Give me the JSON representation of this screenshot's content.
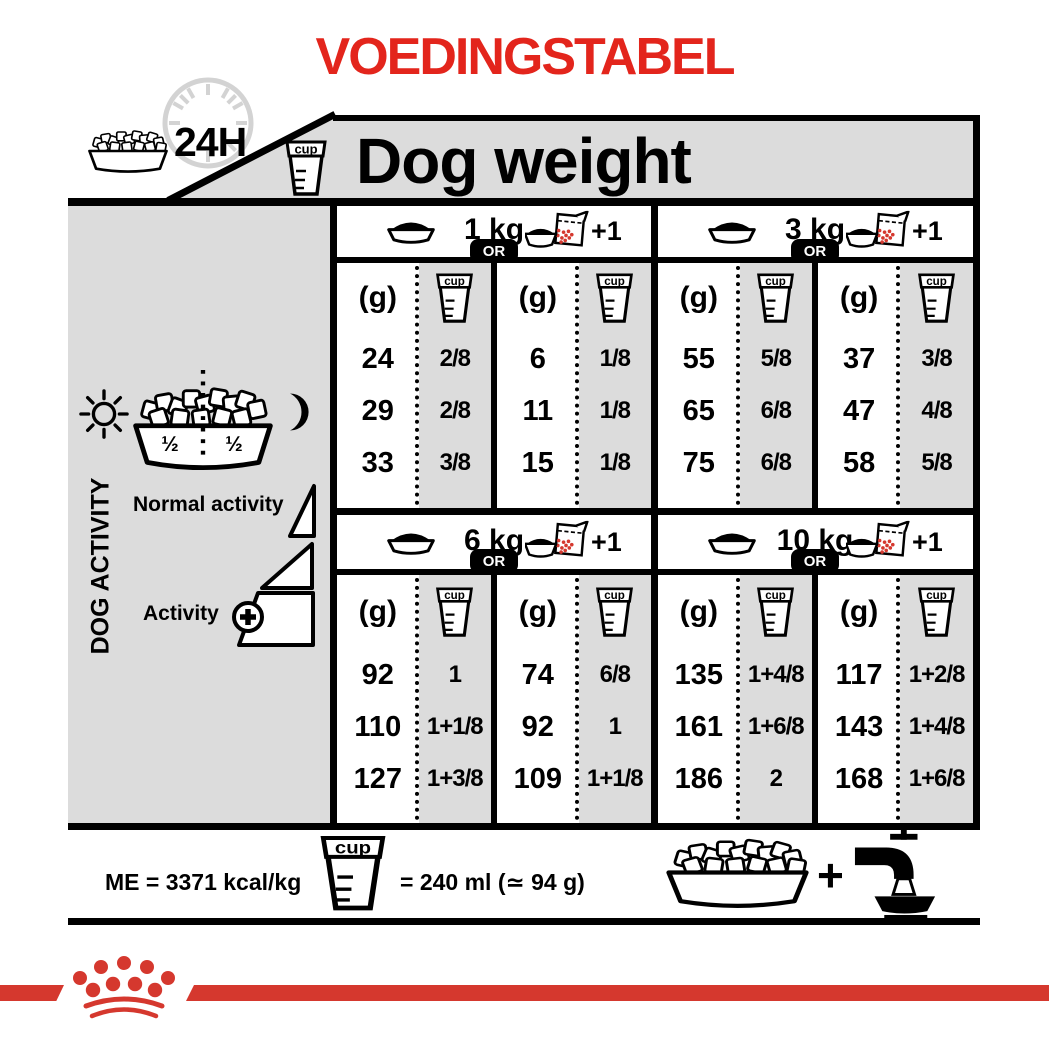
{
  "title": "VOEDINGSTABEL",
  "header": {
    "time_badge": "24H",
    "dog_weight": "Dog weight"
  },
  "sidebar": {
    "dog_activity": "DOG ACTIVITY",
    "half_left": "½",
    "half_right": "½",
    "normal_activity": "Normal activity",
    "activity": "Activity"
  },
  "table": {
    "or": "OR",
    "plus_one": "+1",
    "grams_header": "(g)",
    "cup_label": "cup",
    "sections": [
      {
        "weight": "1 kg",
        "dry": {
          "rows": [
            {
              "g": "24",
              "cup": "2/8"
            },
            {
              "g": "29",
              "cup": "2/8"
            },
            {
              "g": "33",
              "cup": "3/8"
            }
          ]
        },
        "mix": {
          "rows": [
            {
              "g": "6",
              "cup": "1/8"
            },
            {
              "g": "11",
              "cup": "1/8"
            },
            {
              "g": "15",
              "cup": "1/8"
            }
          ]
        }
      },
      {
        "weight": "3 kg",
        "dry": {
          "rows": [
            {
              "g": "55",
              "cup": "5/8"
            },
            {
              "g": "65",
              "cup": "6/8"
            },
            {
              "g": "75",
              "cup": "6/8"
            }
          ]
        },
        "mix": {
          "rows": [
            {
              "g": "37",
              "cup": "3/8"
            },
            {
              "g": "47",
              "cup": "4/8"
            },
            {
              "g": "58",
              "cup": "5/8"
            }
          ]
        }
      },
      {
        "weight": "6 kg",
        "dry": {
          "rows": [
            {
              "g": "92",
              "cup": "1"
            },
            {
              "g": "110",
              "cup": "1+1/8"
            },
            {
              "g": "127",
              "cup": "1+3/8"
            }
          ]
        },
        "mix": {
          "rows": [
            {
              "g": "74",
              "cup": "6/8"
            },
            {
              "g": "92",
              "cup": "1"
            },
            {
              "g": "109",
              "cup": "1+1/8"
            }
          ]
        }
      },
      {
        "weight": "10 kg",
        "dry": {
          "rows": [
            {
              "g": "135",
              "cup": "1+4/8"
            },
            {
              "g": "161",
              "cup": "1+6/8"
            },
            {
              "g": "186",
              "cup": "2"
            }
          ]
        },
        "mix": {
          "rows": [
            {
              "g": "117",
              "cup": "1+2/8"
            },
            {
              "g": "143",
              "cup": "1+4/8"
            },
            {
              "g": "168",
              "cup": "1+6/8"
            }
          ]
        }
      }
    ]
  },
  "footer": {
    "me": "ME = 3371 kcal/kg",
    "cup_equiv": "= 240 ml (≃ 94 g)",
    "plus": "+"
  },
  "colors": {
    "brand_red": "#e3251c",
    "logo_red": "#d5382e",
    "panel_gray": "#dcdcdc",
    "clock_gray": "#d3d3d3"
  }
}
